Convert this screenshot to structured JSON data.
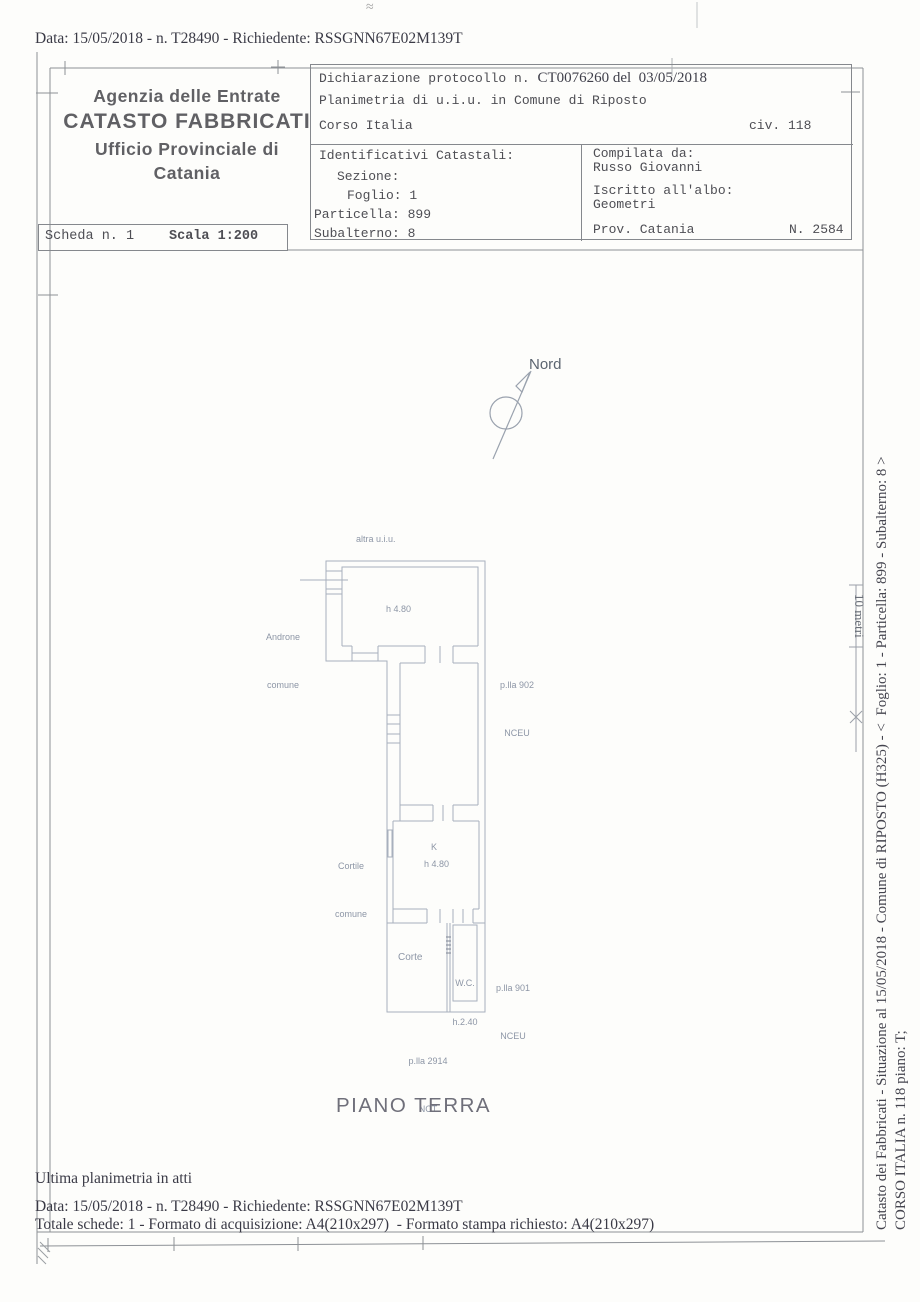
{
  "page": {
    "scan_mark": "≈",
    "header_line": "Data: 15/05/2018 - n. T28490 - Richiedente: RSSGNN67E02M139T",
    "footer": {
      "ultima": "Ultima planimetria in atti",
      "data_line": "Data: 15/05/2018 - n. T28490 - Richiedente: RSSGNN67E02M139T",
      "totale": "Totale schede: 1 - Formato di acquisizione: A4(210x297)  - Formato stampa richiesto: A4(210x297)"
    },
    "side": {
      "line1": "Catasto dei Fabbricati - Situazione al 15/05/2018 - Comune di RIPOSTO (H325) - <  Foglio: 1 - Particella: 899 - Subalterno: 8 >",
      "line2": "CORSO ITALIA n. 118 piano: T;",
      "ruler": "10 metri"
    }
  },
  "office": {
    "line1": "Agenzia delle Entrate",
    "line2": "CATASTO FABBRICATI",
    "line3": "Ufficio Provinciale di",
    "line4": "Catania"
  },
  "scheda": {
    "number": "Scheda n. 1",
    "scale": "Scala 1:200"
  },
  "declaration": {
    "prefix": "Dichiarazione protocollo n. ",
    "number": "CT0076260 del  03/05/2018",
    "planimetria": "Planimetria di u.i.u. in Comune di Riposto",
    "street": "Corso Italia",
    "civic": "civ. 118"
  },
  "catastali": {
    "title": "Identificativi Catastali:",
    "sezione": "Sezione:",
    "foglio": "Foglio: 1",
    "particella": "Particella: 899",
    "subalterno": "Subalterno: 8"
  },
  "compiler": {
    "title": "Compilata da:",
    "name": "Russo Giovanni",
    "albo_label": "Iscritto all'albo:",
    "albo": "Geometri",
    "prov": "Prov. Catania",
    "reg_number": "N. 2584"
  },
  "plan": {
    "nord": "Nord",
    "piano": "PIANO TERRA",
    "labels": {
      "altra": "altra u.i.u.",
      "androne1": "Androne",
      "androne2": "comune",
      "h_top": "h 4.80",
      "p902a": "p.lla 902",
      "p902b": "NCEU",
      "cortile1": "Cortile",
      "cortile2": "comune",
      "k": "K",
      "k_h": "h 4.80",
      "corte": "Corte",
      "wc": "W.C.",
      "wc_h": "h.2.40",
      "p901a": "p.lla 901",
      "p901b": "NCEU",
      "p2914a": "p.lla 2914",
      "p2914b": "NCT"
    }
  },
  "colors": {
    "paper": "#fdfdfb",
    "frame_line": "#8d9196",
    "plan_line": "#a8b0bd",
    "ink_serif": "#3a3a46",
    "ink_mono": "#4e4e54",
    "office_gray": "#606064",
    "label_gray": "#8d96a6"
  }
}
